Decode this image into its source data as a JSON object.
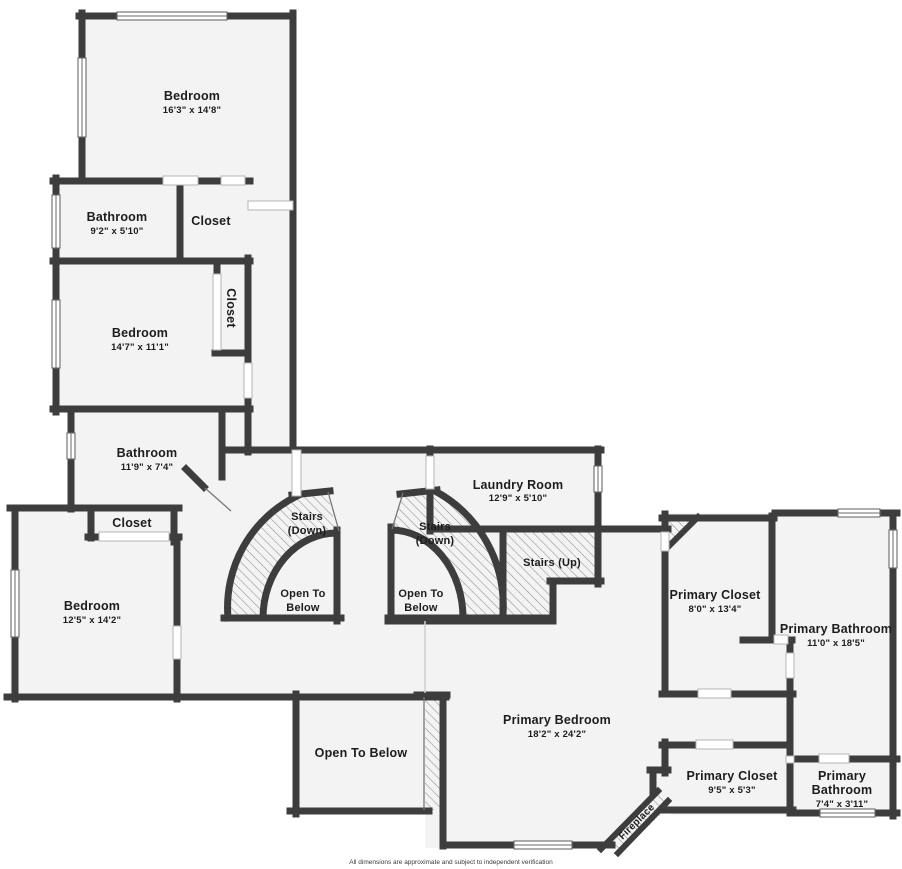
{
  "page": {
    "background": "#ffffff",
    "disclaimer": "All dimensions are approximate and subject to independent verification"
  },
  "colors": {
    "wall": "#3d3d3d",
    "floor": "#f3f3f3",
    "hatch_line": "#8e8e8e",
    "label_text": "#1d1d1d"
  },
  "rooms": {
    "bedroom_top": {
      "name": "Bedroom",
      "dims": "16'3\" x 14'8\""
    },
    "bathroom_top": {
      "name": "Bathroom",
      "dims": "9'2\" x 5'10\""
    },
    "closet_top": {
      "name": "Closet"
    },
    "bedroom_mid": {
      "name": "Bedroom",
      "dims": "14'7\" x 11'1\""
    },
    "closet_mid": {
      "name": "Closet"
    },
    "bathroom_mid": {
      "name": "Bathroom",
      "dims": "11'9\" x 7'4\""
    },
    "closet_lower": {
      "name": "Closet"
    },
    "bedroom_left": {
      "name": "Bedroom",
      "dims": "12'5\" x 14'2\""
    },
    "laundry": {
      "name": "Laundry Room",
      "dims": "12'9\" x 5'10\""
    },
    "primary_closet_upper": {
      "name": "Primary Closet",
      "dims": "8'0\" x 13'4\""
    },
    "primary_bathroom_upper": {
      "name": "Primary Bathroom",
      "dims": "11'0\" x 18'5\""
    },
    "primary_bedroom": {
      "name": "Primary Bedroom",
      "dims": "18'2\" x 24'2\""
    },
    "open_to_below_room": {
      "name": "Open To Below"
    },
    "primary_closet_lower": {
      "name": "Primary Closet",
      "dims": "9'5\" x 5'3\""
    },
    "primary_bathroom_lower": {
      "name_line1": "Primary",
      "name_line2": "Bathroom",
      "dims": "7'4\" x 3'11\""
    },
    "fireplace": {
      "name": "Fireplace"
    }
  },
  "stairs": {
    "left": {
      "label_line1": "Stairs",
      "label_line2": "(Down)",
      "open_line1": "Open To",
      "open_line2": "Below"
    },
    "right": {
      "label_line1": "Stairs",
      "label_line2": "(Down)",
      "open_line1": "Open To",
      "open_line2": "Below"
    },
    "up": {
      "label": "Stairs (Up)"
    }
  }
}
